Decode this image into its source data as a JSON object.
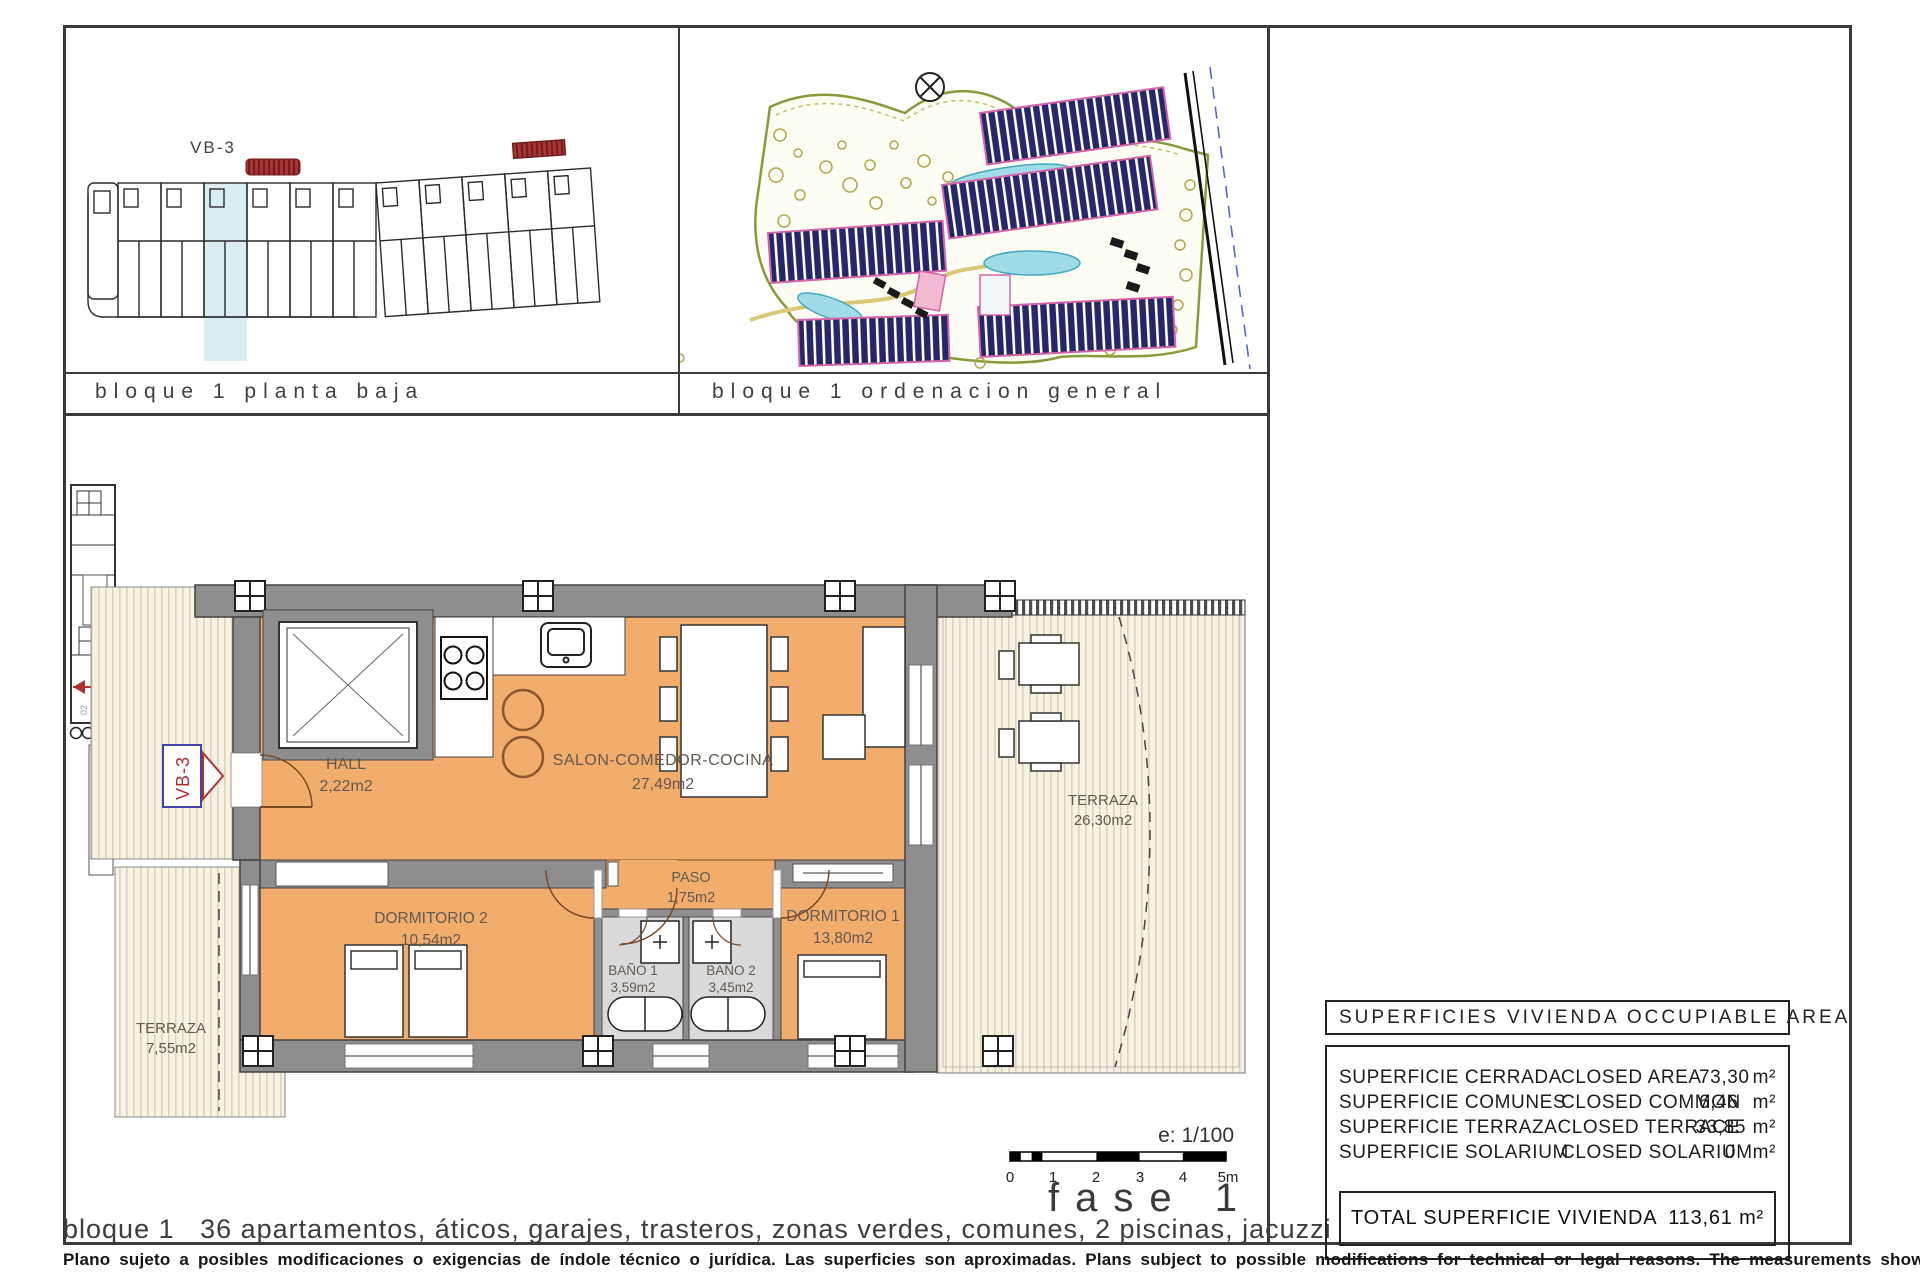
{
  "panels": {
    "planta": {
      "title": "bloque 1 planta baja",
      "unit": "VB-3"
    },
    "orden": {
      "title": "bloque 1 ordenacion general"
    }
  },
  "plan": {
    "unit": "VB-3",
    "stair_labels": {
      "a": "02",
      "b": "01"
    },
    "rooms": {
      "hall": {
        "name": "HALL",
        "area": "2,22m2"
      },
      "salon": {
        "name": "SALON-COMEDOR-COCINA",
        "area": "27,49m2"
      },
      "paso": {
        "name": "PASO",
        "area": "1,75m2"
      },
      "dorm2": {
        "name": "DORMITORIO 2",
        "area": "10,54m2"
      },
      "dorm1": {
        "name": "DORMITORIO 1",
        "area": "13,80m2"
      },
      "bano1": {
        "name": "BAÑO 1",
        "area": "3,59m2"
      },
      "bano2": {
        "name": "BAÑO 2",
        "area": "3,45m2"
      },
      "terraza_izq": {
        "name": "TERRAZA",
        "area": "7,55m2"
      },
      "terraza_der": {
        "name": "TERRAZA",
        "area": "26,30m2"
      }
    }
  },
  "scale": {
    "ratio": "e: 1/100",
    "ticks": [
      "0",
      "1",
      "2",
      "3",
      "4",
      "5m"
    ]
  },
  "phase": "fase 1",
  "footer_title": "bloque 1   36 apartamentos, áticos, garajes, trasteros, zonas verdes, comunes, 2 piscinas, jacuzzi",
  "disclaimer": "Plano sujeto a posibles modificaciones o exigencias de índole técnico o jurídica. Las superficies son aproximadas. Plans subject to possible modifications for technical or legal reasons. The measurements shown are approximate",
  "areas_table": {
    "header": "SUPERFICIES VIVIENDA OCCUPIABLE AREA",
    "rows": [
      {
        "es": "SUPERFICIE CERRADA",
        "en": "CLOSED AREA",
        "value": "73,30",
        "unit": "m²"
      },
      {
        "es": "SUPERFICIE COMUNES",
        "en": "CLOSED COMMON",
        "value": "6,46",
        "unit": "m²"
      },
      {
        "es": "SUPERFICIE TERRAZA",
        "en": "CLOSED TERRACE",
        "value": "33,85",
        "unit": "m²"
      },
      {
        "es": "SUPERFICIE SOLARIUM",
        "en": "CLOSED SOLARIUM",
        "value": "0",
        "unit": "m²"
      }
    ],
    "total_label": "TOTAL SUPERFICIE VIVIENDA",
    "total_value": "113,61 m²"
  },
  "colors": {
    "floor": "#f2ac6c",
    "wall": "#8e8e8e",
    "accent_red": "#b03030",
    "highlight": "#dcedf2"
  }
}
